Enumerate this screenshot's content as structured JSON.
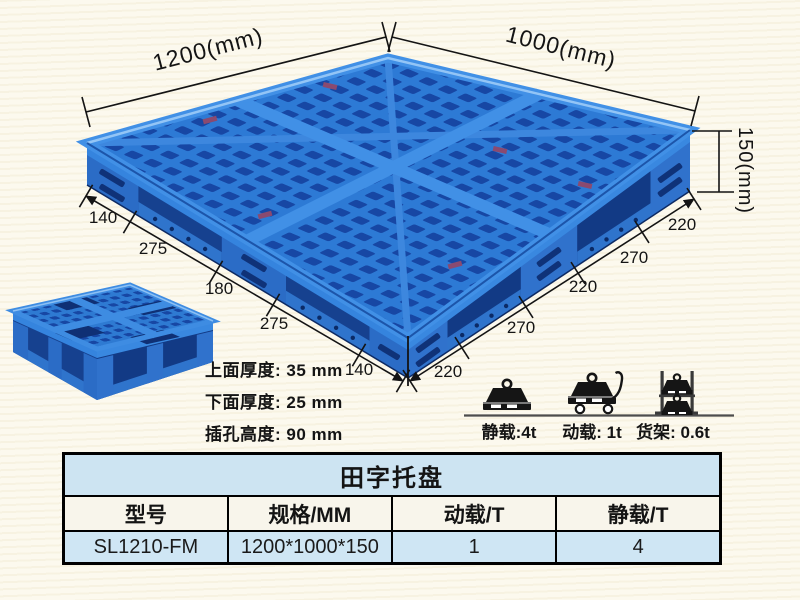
{
  "product": {
    "dimensions": {
      "length_label": "1200(mm)",
      "width_label": "1000(mm)",
      "height_label": "150(mm)",
      "left_edge_segments": [
        "140",
        "275",
        "180",
        "275",
        "140"
      ],
      "right_edge_segments": [
        "220",
        "270",
        "220",
        "270",
        "220"
      ]
    },
    "thickness_notes": [
      "上面厚度: 35 mm",
      "下面厚度: 25 mm",
      "插孔高度: 90 mm"
    ],
    "load_ratings": [
      {
        "icon": "static-load-icon",
        "label": "静载:4t"
      },
      {
        "icon": "dynamic-load-icon",
        "label": "动载: 1t"
      },
      {
        "icon": "rack-load-icon",
        "label": "货架: 0.6t"
      }
    ]
  },
  "spec_table": {
    "title": "田字托盘",
    "headers": [
      "型号",
      "规格/MM",
      "动载/T",
      "静载/T"
    ],
    "row": [
      "SL1210-FM",
      "1200*1000*150",
      "1",
      "4"
    ]
  },
  "colors": {
    "pallet_blue": "#2d7ad5",
    "pallet_hole_dark": "#1747a4",
    "pallet_shadow": "#123a85",
    "pallet_band_light": "#4190e6",
    "table_title_bg": "#cde4f2",
    "table_header_bg": "#f8f5eb",
    "table_data_bg": "#cfe6f4",
    "background_cream": "#fcf9ee",
    "line_black": "#141414"
  }
}
